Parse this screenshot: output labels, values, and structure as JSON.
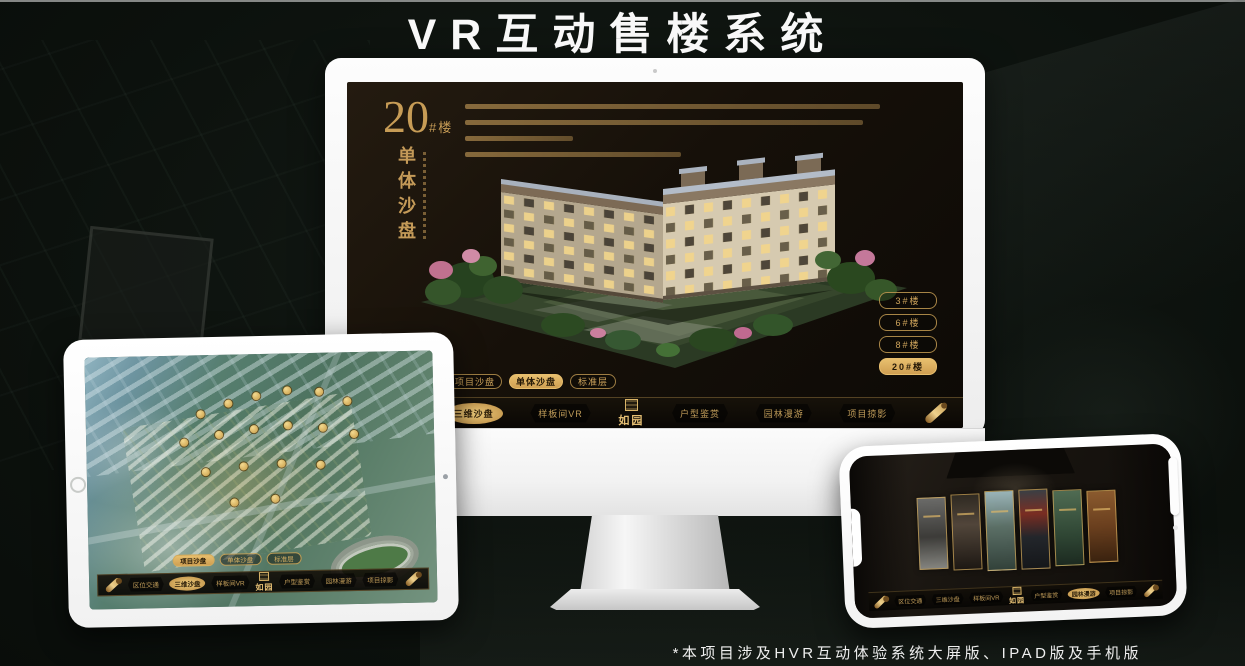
{
  "page": {
    "title": "VR互动售楼系统",
    "footnote": "*本项目涉及HVR互动体验系统大屏版、IPAD版及手机版"
  },
  "colors": {
    "gold": "#c9a35c",
    "gold_bright": "#e8bf6e",
    "gold_text_dark": "#241806",
    "screen_bg": "#161009",
    "title_white": "#f8f8f8"
  },
  "monitor": {
    "headline": {
      "number": "20",
      "unit": "#楼",
      "subtitle_vertical": "单体沙盘"
    },
    "floor_buttons": [
      {
        "label": "3#楼",
        "selected": false
      },
      {
        "label": "6#楼",
        "selected": false
      },
      {
        "label": "8#楼",
        "selected": false
      },
      {
        "label": "20#楼",
        "selected": true
      }
    ],
    "view_tabs": [
      {
        "label": "项目沙盘",
        "selected": false
      },
      {
        "label": "单体沙盘",
        "selected": true
      },
      {
        "label": "标准层",
        "selected": false
      }
    ],
    "nav": {
      "logo": "如园",
      "items": [
        {
          "label": "区位交通",
          "active": false
        },
        {
          "label": "三维沙盘",
          "active": true
        },
        {
          "label": "样板间VR",
          "active": false
        },
        {
          "label": "户型鉴赏",
          "active": false
        },
        {
          "label": "园林漫游",
          "active": false
        },
        {
          "label": "项目掠影",
          "active": false
        }
      ]
    }
  },
  "ipad": {
    "view_tabs": [
      {
        "label": "项目沙盘",
        "selected": true
      },
      {
        "label": "单体沙盘",
        "selected": false
      },
      {
        "label": "标准层",
        "selected": false
      }
    ],
    "nav": {
      "logo": "如园",
      "items": [
        {
          "label": "区位交通",
          "active": false
        },
        {
          "label": "三维沙盘",
          "active": true
        },
        {
          "label": "样板间VR",
          "active": false
        },
        {
          "label": "户型鉴赏",
          "active": false
        },
        {
          "label": "园林漫游",
          "active": false
        },
        {
          "label": "项目掠影",
          "active": false
        }
      ]
    }
  },
  "phone": {
    "nav": {
      "logo": "如园",
      "items": [
        {
          "label": "区位交通",
          "active": false
        },
        {
          "label": "三维沙盘",
          "active": false
        },
        {
          "label": "样板间VR",
          "active": false
        },
        {
          "label": "户型鉴赏",
          "active": false
        },
        {
          "label": "园林漫游",
          "active": true
        },
        {
          "label": "项目掠影",
          "active": false
        }
      ]
    }
  }
}
